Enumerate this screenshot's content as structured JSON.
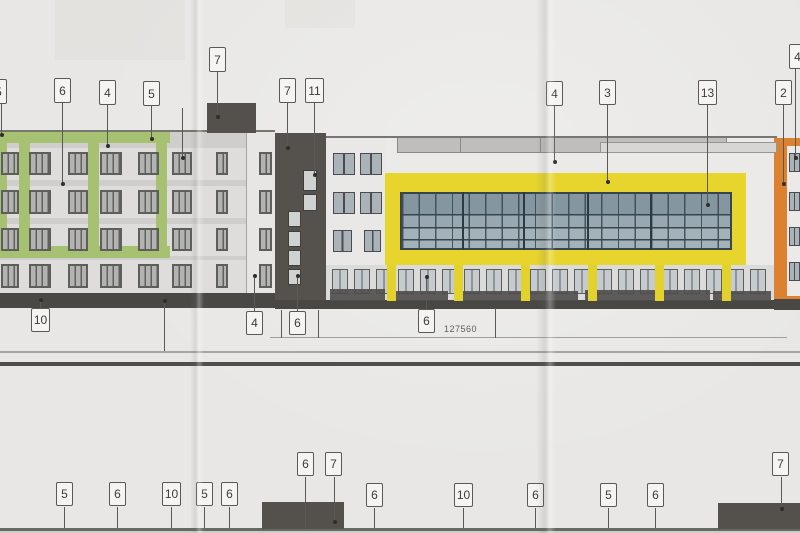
{
  "drawing": {
    "type": "architectural-elevation-photo",
    "dimension_label": "127560",
    "colors": {
      "paper": "#e8e7e5",
      "dark_gray": "#55524d",
      "green_accent": "#a7c172",
      "yellow": "#e7d52d",
      "orange": "#dc8130",
      "glass_blue": "#97a8b0",
      "line": "#5a5954"
    },
    "callouts": [
      {
        "label": "5",
        "x": -10,
        "y": 79,
        "w": 17,
        "h": 25,
        "leader": {
          "x": 1,
          "y1": 104,
          "y2": 134,
          "dot_y": 134
        }
      },
      {
        "label": "6",
        "x": 54,
        "y": 78,
        "w": 17,
        "h": 25,
        "leader": {
          "x": 62,
          "y1": 103,
          "y2": 183,
          "dot_y": 183
        }
      },
      {
        "label": "4",
        "x": 99,
        "y": 80,
        "w": 17,
        "h": 25,
        "leader": {
          "x": 107,
          "y1": 105,
          "y2": 145,
          "dot_y": 145
        }
      },
      {
        "label": "5",
        "x": 143,
        "y": 81,
        "w": 17,
        "h": 25,
        "leader": {
          "x": 151,
          "y1": 106,
          "y2": 138,
          "dot_y": 138
        }
      },
      {
        "label": "7",
        "x": 209,
        "y": 47,
        "w": 17,
        "h": 25,
        "leader": {
          "x": 217,
          "y1": 72,
          "y2": 116,
          "dot_y": 116
        }
      },
      {
        "label": "7",
        "x": 279,
        "y": 78,
        "w": 17,
        "h": 25,
        "leader": {
          "x": 287,
          "y1": 103,
          "y2": 147,
          "dot_y": 147
        }
      },
      {
        "label": "11",
        "x": 305,
        "y": 78,
        "w": 19,
        "h": 25,
        "leader": {
          "x": 314,
          "y1": 103,
          "y2": 174,
          "dot_y": 174
        }
      },
      {
        "label": "4",
        "x": 546,
        "y": 81,
        "w": 17,
        "h": 25,
        "leader": {
          "x": 554,
          "y1": 106,
          "y2": 161,
          "dot_y": 161
        }
      },
      {
        "label": "3",
        "x": 599,
        "y": 80,
        "w": 17,
        "h": 25,
        "leader": {
          "x": 607,
          "y1": 105,
          "y2": 181,
          "dot_y": 181
        }
      },
      {
        "label": "13",
        "x": 698,
        "y": 80,
        "w": 19,
        "h": 25,
        "leader": {
          "x": 707,
          "y1": 105,
          "y2": 204,
          "dot_y": 204
        }
      },
      {
        "label": "2",
        "x": 775,
        "y": 80,
        "w": 17,
        "h": 25,
        "leader": {
          "x": 783,
          "y1": 105,
          "y2": 183,
          "dot_y": 183
        }
      },
      {
        "label": "4",
        "x": 789,
        "y": 44,
        "w": 17,
        "h": 25,
        "leader": {
          "x": 795,
          "y1": 69,
          "y2": 157,
          "dot_y": 157
        }
      },
      {
        "label": "10",
        "x": 31,
        "y": 308,
        "w": 19,
        "h": 24,
        "leader": {
          "x": 40,
          "y1": 297,
          "y2": 308,
          "dot_y": 299
        }
      },
      {
        "label": "4",
        "x": 246,
        "y": 311,
        "w": 17,
        "h": 24,
        "leader": {
          "x": 254,
          "y1": 275,
          "y2": 311,
          "dot_y": 275
        }
      },
      {
        "label": "6",
        "x": 289,
        "y": 311,
        "w": 17,
        "h": 24,
        "leader": {
          "x": 297,
          "y1": 275,
          "y2": 311,
          "dot_y": 275
        }
      },
      {
        "label": "6",
        "x": 418,
        "y": 309,
        "w": 17,
        "h": 24,
        "leader": {
          "x": 426,
          "y1": 276,
          "y2": 309,
          "dot_y": 276
        }
      },
      {
        "label": "6",
        "x": 297,
        "y": 452,
        "w": 17,
        "h": 24,
        "leader": {
          "x": 305,
          "y1": 477,
          "y2": 529
        }
      },
      {
        "label": "7",
        "x": 325,
        "y": 452,
        "w": 17,
        "h": 24,
        "leader": {
          "x": 334,
          "y1": 477,
          "y2": 521,
          "dot_y": 521
        }
      },
      {
        "label": "5",
        "x": 56,
        "y": 482,
        "w": 17,
        "h": 24,
        "leader": {
          "x": 64,
          "y1": 507,
          "y2": 528
        }
      },
      {
        "label": "6",
        "x": 109,
        "y": 482,
        "w": 17,
        "h": 24,
        "leader": {
          "x": 117,
          "y1": 507,
          "y2": 528
        }
      },
      {
        "label": "10",
        "x": 162,
        "y": 482,
        "w": 19,
        "h": 24,
        "leader": {
          "x": 171,
          "y1": 507,
          "y2": 528
        }
      },
      {
        "label": "5",
        "x": 196,
        "y": 482,
        "w": 17,
        "h": 24,
        "leader": {
          "x": 204,
          "y1": 507,
          "y2": 528
        }
      },
      {
        "label": "6",
        "x": 221,
        "y": 482,
        "w": 17,
        "h": 24,
        "leader": {
          "x": 229,
          "y1": 507,
          "y2": 528
        }
      },
      {
        "label": "6",
        "x": 366,
        "y": 483,
        "w": 17,
        "h": 24,
        "leader": {
          "x": 374,
          "y1": 508,
          "y2": 528
        }
      },
      {
        "label": "10",
        "x": 454,
        "y": 483,
        "w": 19,
        "h": 24,
        "leader": {
          "x": 463,
          "y1": 508,
          "y2": 528
        }
      },
      {
        "label": "6",
        "x": 527,
        "y": 483,
        "w": 17,
        "h": 24,
        "leader": {
          "x": 535,
          "y1": 508,
          "y2": 528
        }
      },
      {
        "label": "5",
        "x": 600,
        "y": 483,
        "w": 17,
        "h": 24,
        "leader": {
          "x": 608,
          "y1": 508,
          "y2": 528
        }
      },
      {
        "label": "6",
        "x": 647,
        "y": 483,
        "w": 17,
        "h": 24,
        "leader": {
          "x": 655,
          "y1": 508,
          "y2": 528
        }
      },
      {
        "label": "7",
        "x": 772,
        "y": 452,
        "w": 17,
        "h": 24,
        "leader": {
          "x": 781,
          "y1": 477,
          "y2": 508,
          "dot_y": 508
        }
      }
    ],
    "extra_lines": [
      {
        "x": 182,
        "y1": 108,
        "y2": 157,
        "dot_y": 157
      },
      {
        "x": 164,
        "y1": 300,
        "y2": 351,
        "dot_y": 300
      },
      {
        "x": 495,
        "y1": 308,
        "y2": 338
      },
      {
        "x": 281,
        "y1": 310,
        "y2": 338
      },
      {
        "x": 318,
        "y1": 310,
        "y2": 338
      }
    ],
    "left_windows": {
      "rows": [
        {
          "y": 152,
          "h": 23
        },
        {
          "y": 190,
          "h": 24
        },
        {
          "y": 228,
          "h": 23
        },
        {
          "y": 264,
          "h": 24
        }
      ],
      "cols": [
        [
          1,
          18
        ],
        [
          29,
          22
        ],
        [
          68,
          20
        ],
        [
          100,
          22
        ],
        [
          138,
          21
        ],
        [
          172,
          20
        ],
        [
          216,
          12
        ],
        [
          259,
          13
        ]
      ]
    },
    "light_bands": [
      [
        148,
        32
      ],
      [
        186,
        32
      ],
      [
        224,
        32
      ],
      [
        260,
        33
      ]
    ],
    "green_bars": [
      [
        0,
        132,
        170,
        11
      ],
      [
        0,
        246,
        170,
        12
      ],
      [
        0,
        132,
        7,
        126
      ],
      [
        19,
        132,
        11,
        126
      ],
      [
        88,
        132,
        11,
        126
      ],
      [
        156,
        132,
        11,
        126
      ]
    ],
    "tower_windows": [
      [
        303,
        170,
        14,
        21
      ],
      [
        303,
        194,
        14,
        17
      ],
      [
        288,
        211,
        13,
        16
      ],
      [
        288,
        231,
        13,
        16
      ],
      [
        288,
        250,
        13,
        16
      ],
      [
        288,
        269,
        13,
        16
      ]
    ],
    "mid_windows": [
      [
        333,
        153,
        22,
        22
      ],
      [
        360,
        153,
        22,
        22
      ],
      [
        333,
        192,
        22,
        22
      ],
      [
        360,
        192,
        22,
        22
      ],
      [
        333,
        230,
        19,
        22
      ],
      [
        364,
        230,
        17,
        22
      ]
    ],
    "orange_windows": [
      [
        789,
        153,
        11,
        19
      ],
      [
        789,
        192,
        11,
        19
      ],
      [
        789,
        227,
        11,
        19
      ],
      [
        789,
        262,
        11,
        19
      ]
    ],
    "ground": {
      "columns": [
        387,
        454,
        521,
        588,
        655,
        722
      ],
      "door_start": 332,
      "door_end": 752,
      "door_step": 22,
      "door_y": 269,
      "door_w": 16,
      "door_h": 25
    },
    "dark_strips": [
      [
        330,
        289,
        55,
        12
      ],
      [
        396,
        291,
        52,
        10
      ],
      [
        460,
        291,
        118,
        10
      ],
      [
        585,
        290,
        125,
        11
      ],
      [
        713,
        291,
        58,
        10
      ]
    ],
    "glass_mullions": [
      62,
      123,
      187,
      250
    ],
    "rail_dividers": [
      460,
      540
    ],
    "dark_boxes": [
      [
        207,
        103,
        49,
        30
      ],
      [
        262,
        502,
        82,
        27
      ],
      [
        718,
        503,
        82,
        26
      ]
    ]
  }
}
